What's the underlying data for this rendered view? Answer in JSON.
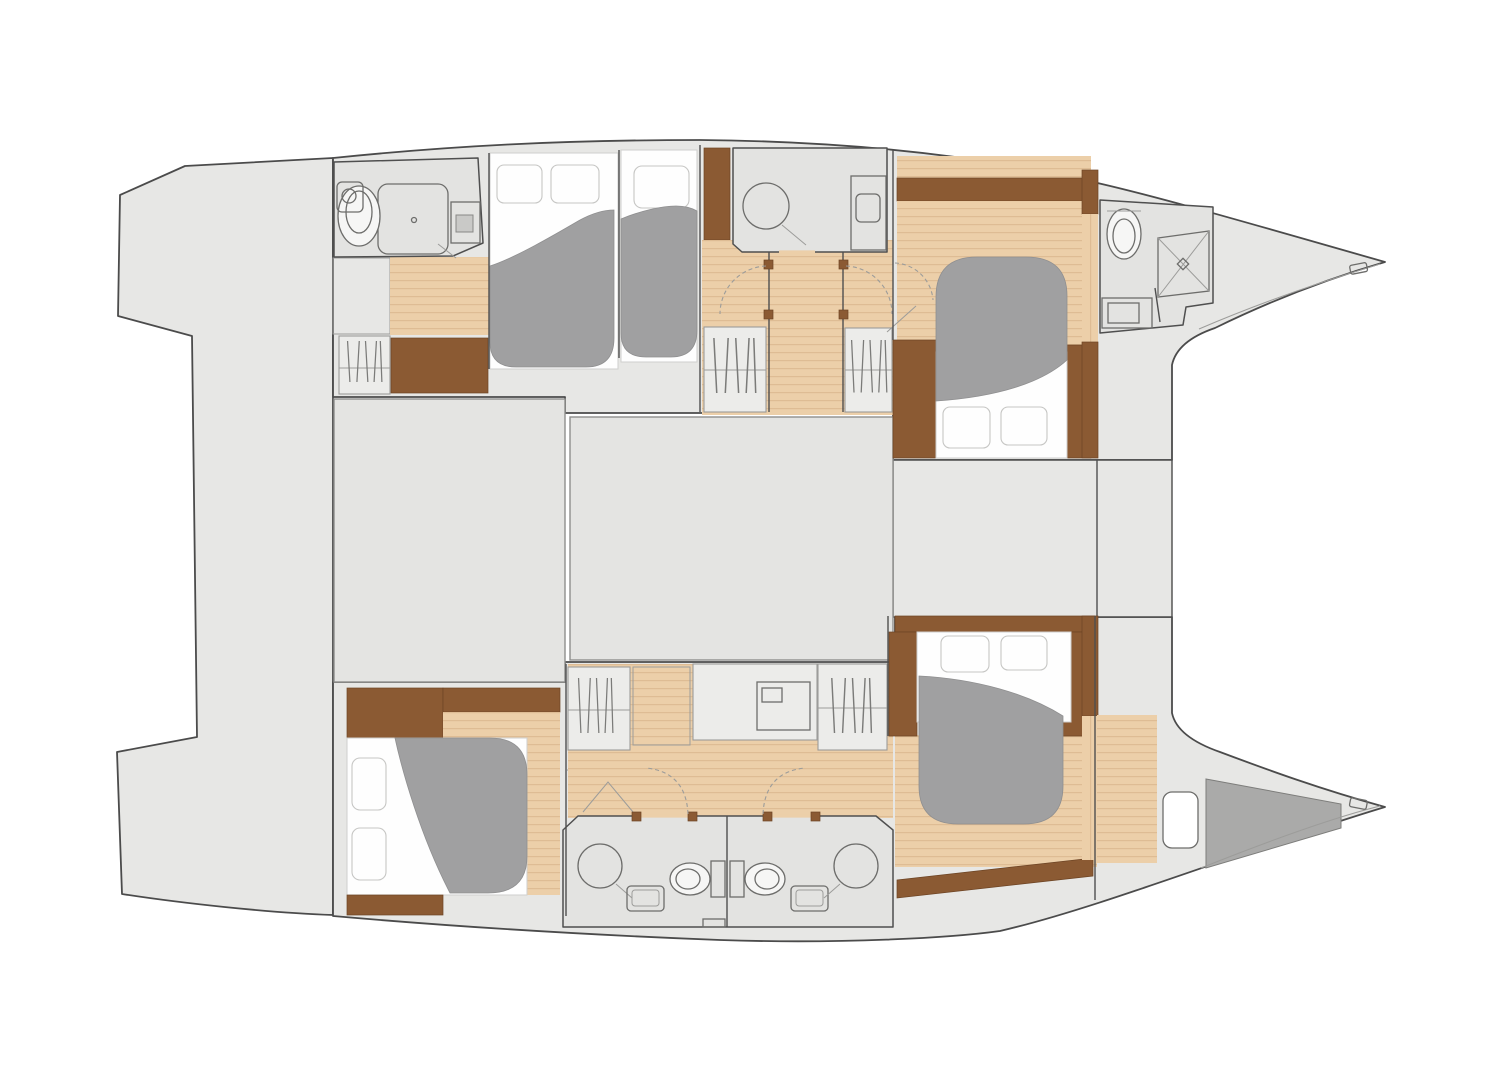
{
  "meta": {
    "title": "Catamaran lower deck floor plan",
    "aria_label": "Top-view interior floor plan of a sailing catamaran: two hulls with five cabins and five bathrooms, bows pointing right",
    "orientation": "bows-right",
    "text_on_image": ""
  },
  "palette": {
    "bg": "#ffffff",
    "deck": "#e7e7e5",
    "deck-outline": "#4b4b4b",
    "block": "#e4e4e2",
    "block-outline": "#8f8f8d",
    "bath": "#e3e3e1",
    "wall": "#4f4f4f",
    "wood": "#eccfa9",
    "wood-line": "#d9b68d",
    "stairs": "#f3e2c6",
    "stairs-line": "#d9c09a",
    "walnut": "#8b5a33",
    "walnut-line": "#6d4424",
    "duvet": "#a0a0a1",
    "duvet-line": "#8f8f90",
    "mattress": "#fefefe",
    "mattress-line": "#cfcfcd",
    "fixture": "#6d6d6b",
    "locker": "#ececea",
    "locker-line": "#9c9c9a",
    "storage": "#aaaaa9",
    "dash": "#9c9c9a"
  },
  "regions": {
    "shared": [
      {
        "name": "transom-platform",
        "side": "aft"
      },
      {
        "name": "saloon-block-aft"
      },
      {
        "name": "saloon-block-forward"
      },
      {
        "name": "foredeck-block"
      },
      {
        "name": "port-bow-deck"
      },
      {
        "name": "starboard-bow-deck"
      },
      {
        "name": "starboard-bow-storage-locker"
      }
    ],
    "port_hull": [
      {
        "name": "aft-head",
        "fixtures": [
          "toilet",
          "shower",
          "sink"
        ]
      },
      {
        "name": "aft-staircase"
      },
      {
        "name": "hanging-locker"
      },
      {
        "name": "aft-cabin-1",
        "bed": "double",
        "pillows": 2
      },
      {
        "name": "aft-cabin-2",
        "bed": "double",
        "pillows": 1
      },
      {
        "name": "mid-head",
        "fixtures": [
          "round-shower",
          "vanity-sink"
        ]
      },
      {
        "name": "corridor-with-wardrobes",
        "hanging_lockers": 2
      },
      {
        "name": "forward-cabin",
        "bed": "island-double",
        "pillows": 2
      },
      {
        "name": "forward-head",
        "fixtures": [
          "toilet",
          "shower-tray",
          "sink"
        ]
      }
    ],
    "starboard_hull": [
      {
        "name": "aft-cabin",
        "bed": "double",
        "pillows": 2
      },
      {
        "name": "corridor-with-wardrobes",
        "hanging_lockers": 2
      },
      {
        "name": "mid-staircase"
      },
      {
        "name": "vanity-unit"
      },
      {
        "name": "twin-heads",
        "fixtures": [
          "shower",
          "sink",
          "toilet",
          "toilet",
          "sink",
          "shower"
        ]
      },
      {
        "name": "forward-cabin",
        "bed": "island-double",
        "pillows": 2
      },
      {
        "name": "bow-compartment",
        "features": [
          "deck-hatch",
          "storage-wedge"
        ]
      }
    ],
    "totals": {
      "cabins": 5,
      "beds": 5,
      "heads": 5,
      "hanging_lockers": 5,
      "staircases": 3
    }
  }
}
